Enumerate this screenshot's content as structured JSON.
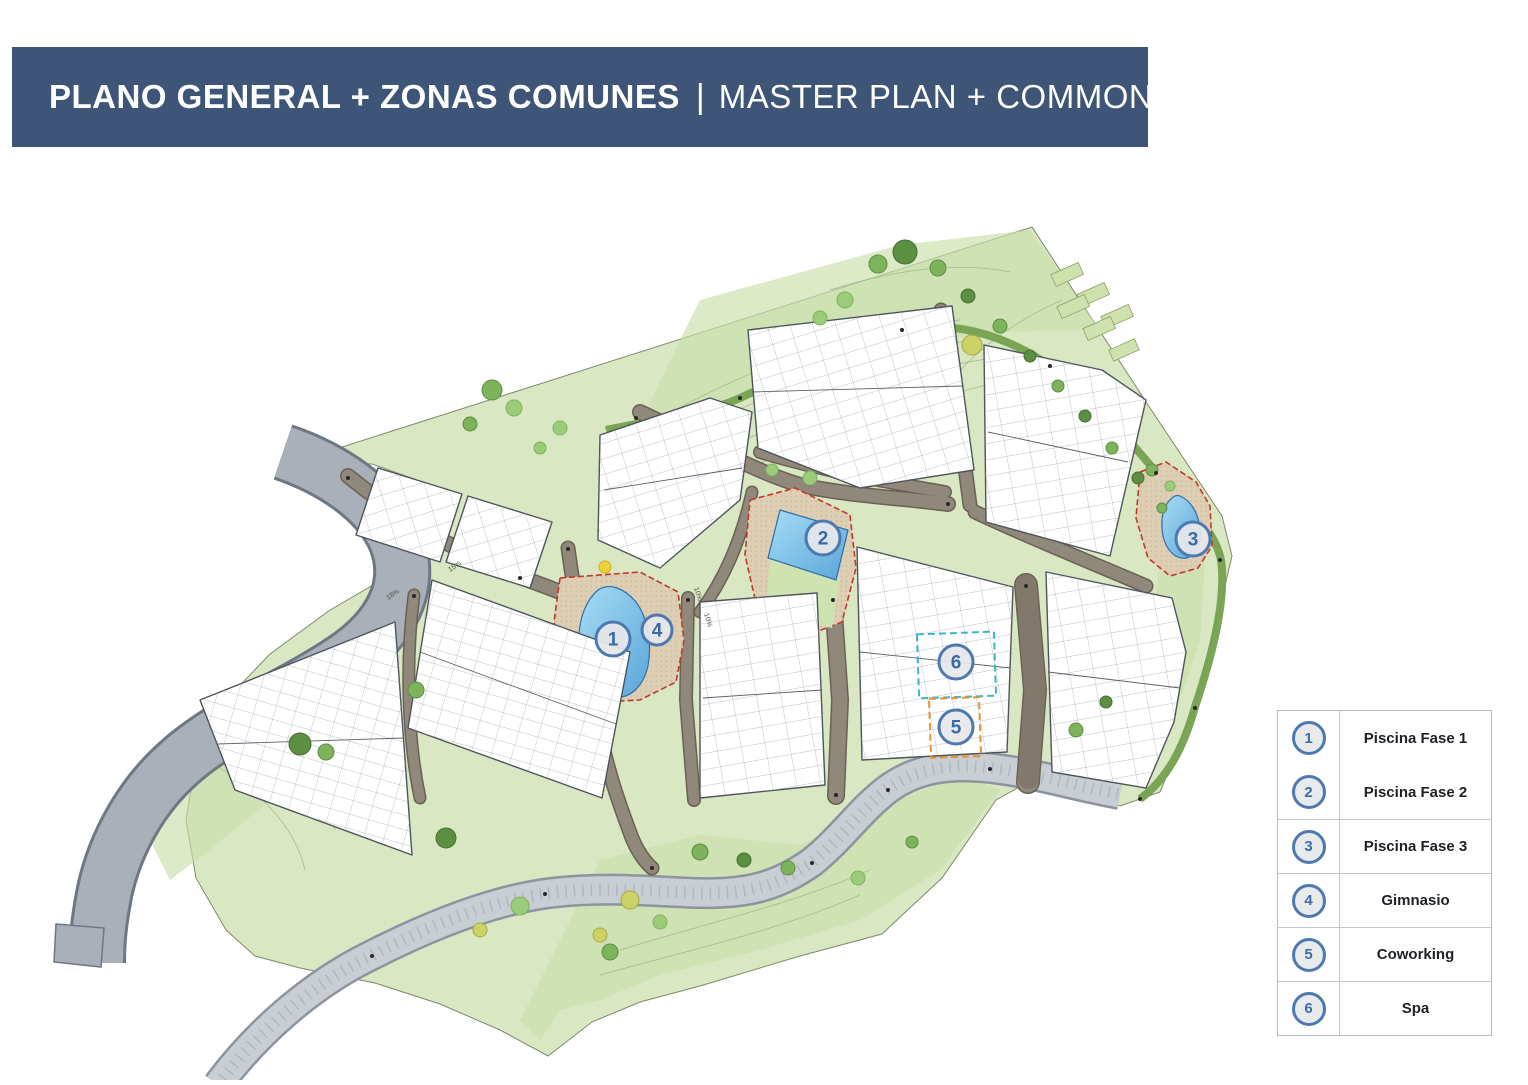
{
  "header": {
    "title_es": "PLANO GENERAL + ZONAS COMUNES",
    "separator": "|",
    "title_en": "MASTER PLAN + COMMON AREAS",
    "bg_color": "#3e5577",
    "text_color": "#ffffff"
  },
  "legend": {
    "items": [
      {
        "num": "1",
        "label": "Piscina Fase 1"
      },
      {
        "num": "2",
        "label": "Piscina Fase 2"
      },
      {
        "num": "3",
        "label": "Piscina Fase 3"
      },
      {
        "num": "4",
        "label": "Gimnasio"
      },
      {
        "num": "5",
        "label": "Coworking"
      },
      {
        "num": "6",
        "label": "Spa"
      }
    ]
  },
  "plan": {
    "markers": [
      {
        "num": "1",
        "area": "piscina-fase-1"
      },
      {
        "num": "2",
        "area": "piscina-fase-2"
      },
      {
        "num": "3",
        "area": "piscina-fase-3"
      },
      {
        "num": "4",
        "area": "gimnasio"
      },
      {
        "num": "5",
        "area": "coworking"
      },
      {
        "num": "6",
        "area": "spa"
      }
    ],
    "road_labels": [
      {
        "text": "18%"
      },
      {
        "text": "15%"
      },
      {
        "text": "10%"
      },
      {
        "text": "10%"
      }
    ],
    "colors": {
      "site_green": "#d9e7c3",
      "dark_patch_green": "#c9dfab",
      "path_green": "#74a14f",
      "road_gray": "#a9b0b9",
      "promenade_gray": "#c9ced5",
      "internal_road_brown": "#90887b",
      "pool_blue": "#8fccec",
      "deck_beige": "#decfb4",
      "boundary_red": "#c0392b",
      "spa_cyan": "#3bb7c9",
      "coworking_orange": "#e8922e",
      "marker_ring": "#4d79b0",
      "building_white": "#ffffff"
    }
  }
}
